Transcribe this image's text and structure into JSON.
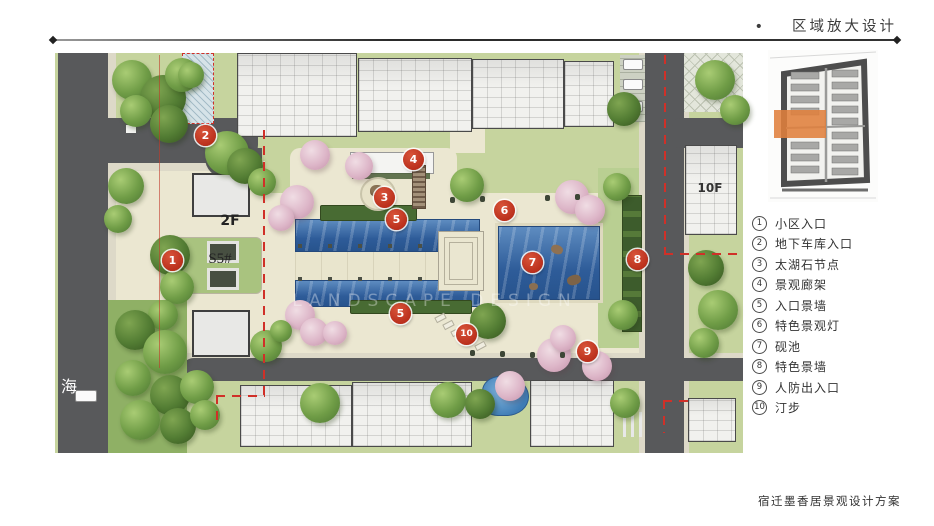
{
  "title": {
    "bullet": "•",
    "text": "区域放大设计"
  },
  "footer": {
    "text": "宿迁墨香居景观设计方案"
  },
  "watermark": {
    "text": "LANDSCAPE DESIGN"
  },
  "legend": {
    "items": [
      {
        "num": "1",
        "label": "小区入口"
      },
      {
        "num": "2",
        "label": "地下车库入口"
      },
      {
        "num": "3",
        "label": "太湖石节点"
      },
      {
        "num": "4",
        "label": "景观廊架"
      },
      {
        "num": "5",
        "label": "入口景墙"
      },
      {
        "num": "6",
        "label": "特色景观灯"
      },
      {
        "num": "7",
        "label": "砚池"
      },
      {
        "num": "8",
        "label": "特色景墙"
      },
      {
        "num": "9",
        "label": "人防出入口"
      },
      {
        "num": "10",
        "label": "汀步"
      }
    ]
  },
  "plan": {
    "labels": {
      "gatehouse": "2F",
      "block": "S5#",
      "tower": "10F",
      "street": "海"
    },
    "markers": [
      "1",
      "2",
      "3",
      "4",
      "5",
      "5",
      "6",
      "7",
      "8",
      "9",
      "10"
    ]
  },
  "colors": {
    "marker_red": "#bf3426",
    "boundary_red": "#d03028",
    "water_blue": "#3f6fae",
    "road_gray": "#58595b",
    "lawn_green": "#b9cf92",
    "plaza_beige": "#ebe7d1",
    "highlight_orange": "#e0803c"
  }
}
